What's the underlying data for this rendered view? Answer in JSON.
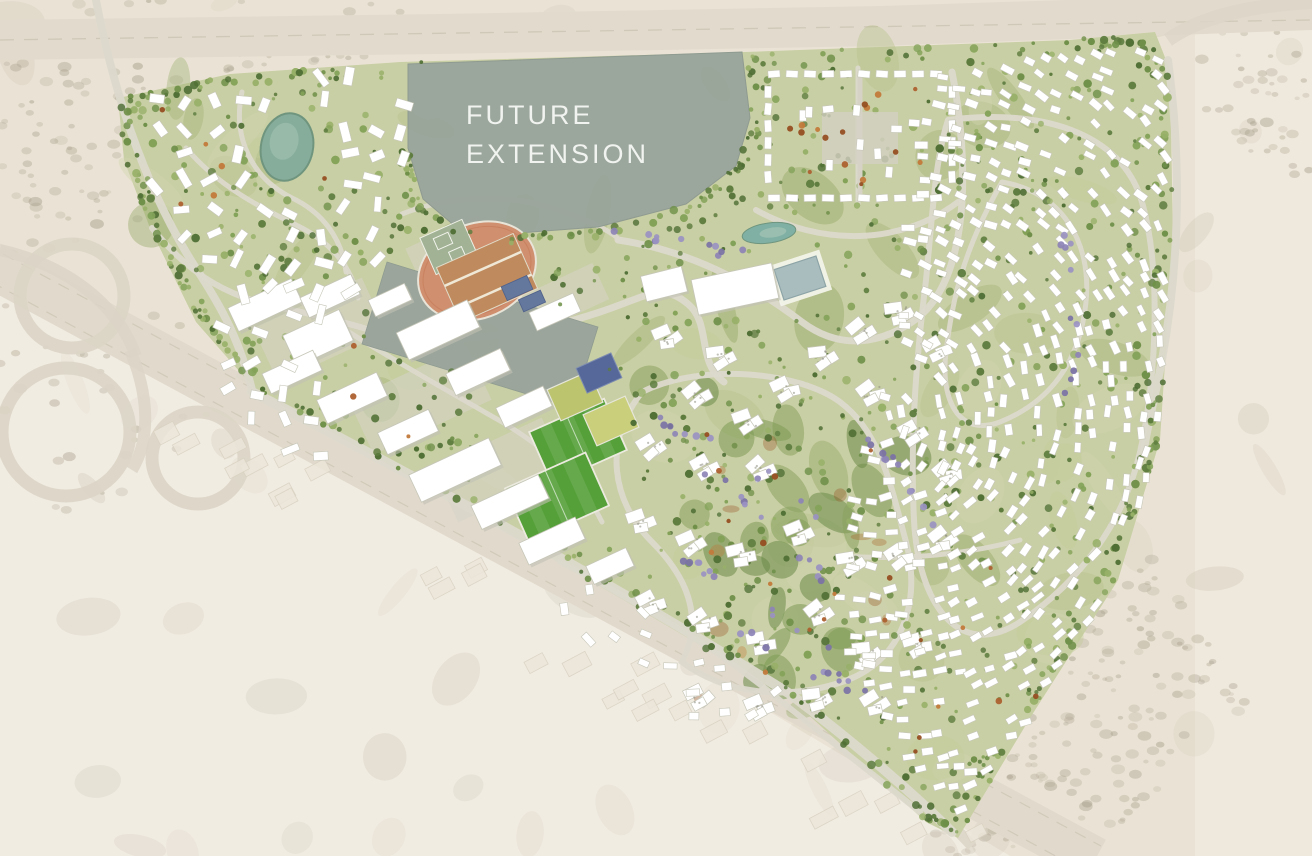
{
  "labels": {
    "future_extension": "FUTURE EXTENSION"
  },
  "canvas": {
    "width": 1312,
    "height": 856
  },
  "seed": 7,
  "palette": {
    "desert_base": "#eae3d5",
    "desert_light": "#f4f0e8",
    "desert_right": "#f1ece2",
    "desert_mottle": "#b5ab97",
    "desert_speckles": [
      "#b2a996",
      "#a8a08d",
      "#bdb4a1"
    ],
    "highway_band": "#e2dbcd",
    "highway_line": "#cbc2b1",
    "highway_diagonal": "#e1dacc",
    "service_road": "#ded8ca",
    "ghost_building_fill": "#ece6da",
    "ghost_building_stroke": "#d9d2c2",
    "site_base": "#c9cfa4",
    "site_soft_greens": [
      "#b7c28d",
      "#a3b377",
      "#93a766",
      "#d2d3b0",
      "#c3cd9a"
    ],
    "park_greens": [
      "#7d9a55",
      "#6b8a48",
      "#88a35f"
    ],
    "rust_patches": [
      "#a8602c",
      "#964f22",
      "#bf7434"
    ],
    "pavement": "#d5d3c6",
    "road_fill": "#dcd9cc",
    "future_extension_fill": "#9ba69c",
    "future_extension_edge": "#8e9a90",
    "reserved_plot_fill": "#9aa49b",
    "track_oval": "#d08f6e",
    "track_edge": "#c57a58",
    "track_infield": "#bf8b5e",
    "track_infield_line": "#efe8d6",
    "track_court": "#a2b295",
    "pitch_green": "#55a039",
    "field_light_a": "#bdc46e",
    "field_light_b": "#cacf7c",
    "court_navy": "#56689a",
    "lake": "#86ac9c",
    "lake_deep": "#6f957f",
    "lake_light": "#a5c6b5",
    "lagoon": "#7fb0a3",
    "pool": "#a9bdbf",
    "pool_edge": "#8da4a6",
    "pool_deck": "#f3f3ea",
    "building_white": "#ffffff",
    "building_stroke": "#c6c6b8",
    "building_shadow": "#c2c2b4",
    "roof_blue": "#64779c",
    "tree_greens": [
      "#4f6f35",
      "#5d7c3e",
      "#6f9049",
      "#83a258",
      "#97b068"
    ],
    "tree_purple": [
      "#8d84b6",
      "#7b72a6",
      "#9a92c2"
    ],
    "tree_orange": [
      "#ad6130",
      "#964f22",
      "#c27a3b"
    ],
    "label_text": "#f4f6f3"
  },
  "features": {
    "site_outline": [
      [
        118,
        98
      ],
      [
        230,
        74
      ],
      [
        400,
        62
      ],
      [
        745,
        52
      ],
      [
        1070,
        40
      ],
      [
        1155,
        32
      ],
      [
        1170,
        70
      ],
      [
        1173,
        240
      ],
      [
        1160,
        440
      ],
      [
        1118,
        580
      ],
      [
        1030,
        718
      ],
      [
        958,
        838
      ],
      [
        926,
        822
      ],
      [
        790,
        698
      ],
      [
        620,
        598
      ],
      [
        430,
        488
      ],
      [
        254,
        388
      ],
      [
        196,
        322
      ],
      [
        150,
        228
      ],
      [
        124,
        160
      ]
    ],
    "future_extension": [
      [
        408,
        64
      ],
      [
        742,
        52
      ],
      [
        750,
        118
      ],
      [
        736,
        166
      ],
      [
        686,
        204
      ],
      [
        598,
        227
      ],
      [
        518,
        233
      ],
      [
        456,
        227
      ],
      [
        423,
        199
      ],
      [
        408,
        148
      ]
    ],
    "reserved_plot": [
      [
        387,
        262
      ],
      [
        598,
        327
      ],
      [
        573,
        408
      ],
      [
        362,
        344
      ]
    ],
    "track": {
      "cx": 477,
      "cy": 271,
      "rx": 61,
      "ry": 47,
      "rot": -24
    },
    "track_infield": {
      "cx": 487,
      "cy": 278,
      "w": 84,
      "h": 60,
      "rot": -24
    },
    "track_court": {
      "cx": 449,
      "cy": 247,
      "w": 46,
      "h": 40,
      "rot": -24
    },
    "track_blue_roofs": [
      [
        517,
        288,
        28,
        15
      ],
      [
        532,
        301,
        24,
        13
      ]
    ],
    "track_white_slab": [
      555,
      312,
      48,
      20
    ],
    "pitches": [
      {
        "cx": 578,
        "cy": 441,
        "w": 82,
        "h": 56,
        "rot": -24
      },
      {
        "cx": 557,
        "cy": 497,
        "w": 88,
        "h": 58,
        "rot": -24
      }
    ],
    "light_fields": [
      {
        "cx": 575,
        "cy": 396,
        "w": 46,
        "h": 34,
        "rot": -24,
        "key": "field_light_a"
      },
      {
        "cx": 611,
        "cy": 421,
        "w": 46,
        "h": 34,
        "rot": -24,
        "key": "field_light_b"
      }
    ],
    "navy_court": {
      "cx": 599,
      "cy": 373,
      "w": 38,
      "h": 27,
      "rot": -24
    },
    "lake": {
      "cx": 287,
      "cy": 147,
      "rx": 26,
      "ry": 34,
      "rot": 12
    },
    "lagoon": {
      "cx": 769,
      "cy": 233,
      "rx": 27,
      "ry": 10,
      "rot": -8
    },
    "pool": {
      "cx": 800,
      "cy": 278,
      "w": 44,
      "h": 32,
      "rot": -18
    },
    "clubhouses": [
      [
        664,
        284,
        42,
        26,
        -14
      ],
      [
        735,
        289,
        82,
        36,
        -12
      ]
    ],
    "campus_buildings": [
      [
        265,
        305,
        70,
        26
      ],
      [
        330,
        296,
        56,
        22
      ],
      [
        318,
        338,
        62,
        34
      ],
      [
        292,
        372,
        56,
        22
      ],
      [
        352,
        398,
        66,
        26
      ],
      [
        408,
        432,
        56,
        24
      ],
      [
        438,
        330,
        78,
        30
      ],
      [
        478,
        372,
        60,
        24
      ],
      [
        524,
        407,
        52,
        22
      ],
      [
        455,
        470,
        88,
        30
      ],
      [
        510,
        502,
        74,
        26
      ],
      [
        552,
        541,
        62,
        24
      ],
      [
        610,
        566,
        44,
        20
      ],
      [
        390,
        300,
        40,
        18
      ]
    ],
    "pavements": [
      [
        320,
        330,
        120,
        60
      ],
      [
        420,
        400,
        130,
        60
      ],
      [
        500,
        470,
        120,
        60
      ],
      [
        560,
        300,
        90,
        40
      ],
      [
        450,
        250,
        80,
        40
      ]
    ],
    "compound": {
      "x": 762,
      "y": 66,
      "w": 196,
      "h": 142
    },
    "central_blobs": [
      [
        668,
        336
      ],
      [
        722,
        356
      ],
      [
        698,
        394
      ],
      [
        748,
        420
      ],
      [
        786,
        388
      ],
      [
        824,
        356
      ],
      [
        862,
        330
      ],
      [
        900,
        312
      ],
      [
        938,
        348
      ],
      [
        872,
        392
      ],
      [
        914,
        432
      ],
      [
        948,
        472
      ],
      [
        762,
        468
      ],
      [
        706,
        466
      ],
      [
        652,
        446
      ],
      [
        642,
        520
      ],
      [
        692,
        542
      ],
      [
        742,
        554
      ],
      [
        800,
        532
      ],
      [
        852,
        562
      ],
      [
        900,
        556
      ],
      [
        944,
        538
      ],
      [
        820,
        612
      ],
      [
        762,
        642
      ],
      [
        704,
        620
      ],
      [
        652,
        602
      ],
      [
        868,
        652
      ],
      [
        918,
        644
      ],
      [
        760,
        706
      ],
      [
        818,
        698
      ],
      [
        700,
        696
      ],
      [
        876,
        702
      ]
    ],
    "villa_regions": [
      {
        "name": "east-field",
        "poly": [
          [
            926,
            70
          ],
          [
            1160,
            40
          ],
          [
            1168,
            70
          ],
          [
            1172,
            240
          ],
          [
            1158,
            445
          ],
          [
            1116,
            582
          ],
          [
            1030,
            716
          ],
          [
            956,
            818
          ],
          [
            888,
            752
          ],
          [
            842,
            648
          ],
          [
            838,
            555
          ],
          [
            862,
            466
          ],
          [
            894,
            360
          ],
          [
            906,
            228
          ],
          [
            914,
            130
          ]
        ],
        "step": 17,
        "keep": 0.72,
        "w": 11.5,
        "h": 6.5,
        "swirl": [
          880,
          420
        ],
        "jit": 14
      },
      {
        "name": "left-cluster",
        "poly": [
          [
            132,
            102
          ],
          [
            250,
            82
          ],
          [
            360,
            74
          ],
          [
            412,
            92
          ],
          [
            420,
            168
          ],
          [
            392,
            238
          ],
          [
            420,
            298
          ],
          [
            430,
            356
          ],
          [
            368,
            330
          ],
          [
            298,
            318
          ],
          [
            232,
            298
          ],
          [
            176,
            230
          ],
          [
            138,
            162
          ]
        ],
        "step": 27,
        "keep": 0.8,
        "w": 17,
        "h": 8,
        "swirl": null,
        "jit": 90
      },
      {
        "name": "left-cluster-south",
        "poly": [
          [
            200,
            302
          ],
          [
            282,
            330
          ],
          [
            332,
            390
          ],
          [
            352,
            452
          ],
          [
            300,
            498
          ],
          [
            238,
            428
          ],
          [
            196,
            350
          ]
        ],
        "step": 30,
        "keep": 0.8,
        "w": 15,
        "h": 8,
        "swirl": null,
        "jit": 90
      },
      {
        "name": "south-villas",
        "poly": [
          [
            560,
            560
          ],
          [
            700,
            630
          ],
          [
            780,
            692
          ],
          [
            742,
            740
          ],
          [
            640,
            692
          ],
          [
            540,
            608
          ]
        ],
        "step": 26,
        "keep": 0.6,
        "w": 12,
        "h": 7,
        "swirl": [
          690,
          560
        ],
        "jit": 14
      }
    ],
    "roads": [
      {
        "d": "M 252,392 C 420,478 620,588 790,694 C 880,762 935,815 952,832",
        "w": 10
      },
      {
        "d": "M 96,0 C 112,84 142,182 192,262 C 218,302 238,334 252,390",
        "w": 8
      },
      {
        "d": "M 152,228 C 192,278 232,298 282,308 C 332,318 372,330 402,340",
        "w": 6
      },
      {
        "d": "M 186,148 C 220,188 262,208 302,228 C 332,244 352,268 358,298",
        "w": 5
      },
      {
        "d": "M 242,92 C 232,138 252,178 292,198 C 322,212 342,238 346,272",
        "w": 5
      },
      {
        "d": "M 400,338 C 480,342 540,332 600,312 C 648,296 662,282 688,304 C 712,324 696,362 724,382",
        "w": 7
      },
      {
        "d": "M 618,240 C 700,252 762,292 802,322 C 842,352 882,342 912,322 C 942,302 958,262 962,202 C 965,152 958,102 952,72",
        "w": 7
      },
      {
        "d": "M 948,120 C 1040,108 1122,132 1142,202 C 1162,272 1156,382 1140,452 C 1124,522 1080,582 1020,622 C 958,662 918,602 914,520 C 910,440 916,360 926,280 C 933,210 935,160 948,120",
        "w": 6
      },
      {
        "d": "M 1002,182 C 1062,192 1092,242 1086,302 C 1080,362 1050,402 1000,422 C 960,437 940,402 946,352 C 952,302 962,252 1002,182",
        "w": 5
      },
      {
        "d": "M 642,392 C 602,442 612,502 652,542 C 692,582 702,622 682,662 C 722,692 782,702 842,682 C 902,662 922,602 906,542 C 890,482 880,432 840,402 C 800,372 702,362 642,392",
        "w": 6
      },
      {
        "d": "M 560,562 C 640,602 722,652 782,702 C 832,742 882,782 920,812",
        "w": 6
      },
      {
        "d": "M 756,210 C 820,246 900,246 958,202",
        "w": 6
      },
      {
        "d": "M 1168,60 C 1180,150 1182,250 1162,360 C 1152,412 1146,432 1144,450",
        "w": 8
      },
      {
        "d": "M 302,302 C 362,342 432,382 502,422 C 552,452 582,482 602,522",
        "w": 5
      },
      {
        "d": "M 402,214 C 442,198 502,192 552,208 C 592,220 622,238 618,240",
        "w": 5
      },
      {
        "d": "M 858,68 L 858,206",
        "w": 5
      },
      {
        "d": "M 842,556 C 900,560 960,556 1020,540",
        "w": 5
      }
    ],
    "highways": {
      "top_band": [
        [
          0,
          20
        ],
        [
          440,
          14
        ],
        [
          880,
          6
        ],
        [
          1312,
          -8
        ],
        [
          1312,
          30
        ],
        [
          880,
          46
        ],
        [
          440,
          54
        ],
        [
          0,
          60
        ]
      ],
      "top_line": "M 0,40 L 1312,20",
      "diagonal": {
        "d": "M -40,248 L 1095,860",
        "w": 46
      },
      "diagonal_lines": [
        "M -46,262 L 1089,874",
        "M -34,234 L 1101,846"
      ],
      "service": "M 238,372 C 420,472 640,592 820,712 C 900,772 950,822 972,846",
      "loops": [
        [
          72,
          296,
          52
        ],
        [
          66,
          432,
          64
        ],
        [
          198,
          458,
          46
        ]
      ],
      "ramps": [
        "M 0,250 C 70,266 118,306 136,356",
        "M 130,350 C 150,398 150,440 132,470"
      ],
      "right_fade": "M 1168,40 C 1196,20 1240,6 1312,2"
    },
    "ghost_band": {
      "count": 36,
      "line": [
        -40,
        248,
        1095,
        860
      ],
      "offset": [
        45,
        170
      ]
    },
    "speckle_regions": [
      {
        "poly": [
          [
            0,
            0
          ],
          [
            430,
            0
          ],
          [
            390,
            120
          ],
          [
            210,
            220
          ],
          [
            0,
            262
          ]
        ],
        "n": 120
      },
      {
        "poly": [
          [
            990,
            600
          ],
          [
            1150,
            556
          ],
          [
            1260,
            700
          ],
          [
            1090,
            856
          ],
          [
            950,
            856
          ],
          [
            934,
            836
          ]
        ],
        "n": 150
      },
      {
        "poly": [
          [
            1180,
            40
          ],
          [
            1312,
            10
          ],
          [
            1312,
            200
          ],
          [
            1210,
            120
          ]
        ],
        "n": 45
      },
      {
        "poly": [
          [
            0,
            262
          ],
          [
            180,
            298
          ],
          [
            230,
            392
          ],
          [
            120,
            520
          ],
          [
            0,
            520
          ]
        ],
        "n": 36
      }
    ],
    "park_poly": [
      [
        640,
        380
      ],
      [
        900,
        400
      ],
      [
        930,
        520
      ],
      [
        880,
        640
      ],
      [
        760,
        700
      ],
      [
        660,
        640
      ],
      [
        620,
        500
      ]
    ],
    "tree_counts": {
      "site": 880,
      "rim": 260,
      "fe_rim": 70
    },
    "purple_paths": [
      [
        [
          656,
          420
        ],
        [
          716,
          446
        ],
        [
          776,
          470
        ],
        [
          826,
          530
        ]
      ],
      [
        [
          700,
          470
        ],
        [
          752,
          502
        ],
        [
          792,
          538
        ],
        [
          820,
          580
        ]
      ],
      [
        [
          688,
          560
        ],
        [
          744,
          596
        ],
        [
          792,
          622
        ],
        [
          842,
          650
        ]
      ],
      [
        [
          846,
          420
        ],
        [
          888,
          458
        ],
        [
          916,
          490
        ],
        [
          930,
          522
        ]
      ],
      [
        [
          616,
          232
        ],
        [
          668,
          242
        ],
        [
          716,
          250
        ],
        [
          748,
          256
        ]
      ],
      [
        [
          1052,
          188
        ],
        [
          1072,
          252
        ],
        [
          1080,
          322
        ],
        [
          1068,
          402
        ]
      ],
      [
        [
          742,
          632
        ],
        [
          780,
          656
        ],
        [
          826,
          676
        ],
        [
          868,
          690
        ]
      ]
    ],
    "orange_regions": [
      [
        770,
        80,
        950,
        200,
        16
      ],
      [
        700,
        420,
        900,
        700,
        14
      ],
      [
        300,
        330,
        560,
        560,
        8
      ],
      [
        880,
        560,
        1060,
        780,
        9
      ],
      [
        150,
        90,
        400,
        300,
        7
      ]
    ]
  }
}
